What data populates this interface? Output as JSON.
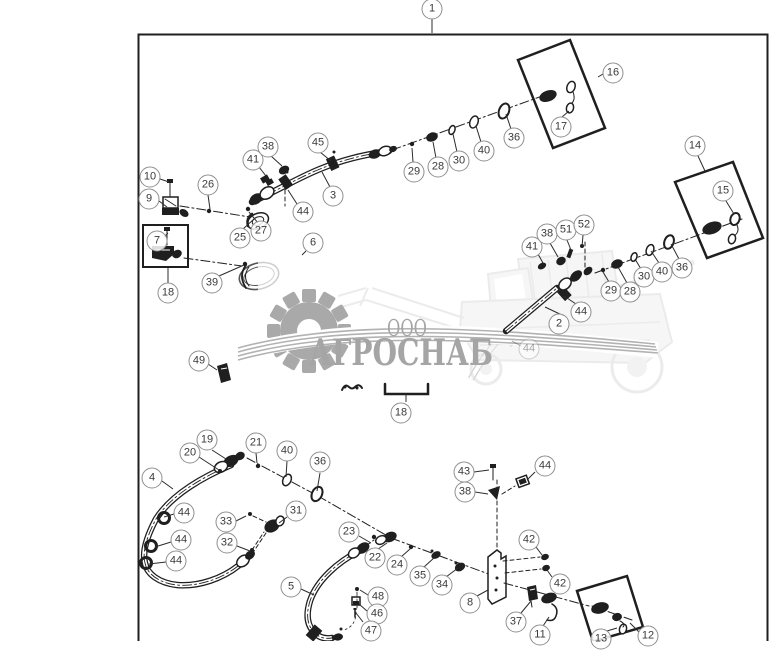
{
  "watermark": {
    "prefix": "ООО",
    "name": "АГРОСНАБ"
  },
  "colors": {
    "line": "#1f1f1f",
    "leader": "#2c2c2c",
    "callout-border": "#8f8f8f",
    "callout-text": "#3a3a3a",
    "wm-text": "#a5a5a5",
    "wm-art": "#dcdcdc",
    "wm-art2": "#f0f0f0",
    "gear": "#a9a9a9"
  },
  "callouts": [
    {
      "id": "1",
      "x": 432,
      "y": 9
    },
    {
      "id": "10",
      "x": 150,
      "y": 177
    },
    {
      "id": "9",
      "x": 149,
      "y": 199
    },
    {
      "id": "26",
      "x": 208,
      "y": 185
    },
    {
      "id": "7",
      "x": 157,
      "y": 241
    },
    {
      "id": "18",
      "x": 168,
      "y": 293
    },
    {
      "id": "25",
      "x": 240,
      "y": 238
    },
    {
      "id": "27",
      "x": 261,
      "y": 231
    },
    {
      "id": "39",
      "x": 212,
      "y": 283
    },
    {
      "id": "6",
      "x": 313,
      "y": 243
    },
    {
      "id": "49",
      "x": 199,
      "y": 361
    },
    {
      "id": "41",
      "x": 253,
      "y": 160
    },
    {
      "id": "38",
      "x": 268,
      "y": 147
    },
    {
      "id": "45",
      "x": 318,
      "y": 143
    },
    {
      "id": "3",
      "x": 333,
      "y": 196
    },
    {
      "id": "44",
      "x": 303,
      "y": 212
    },
    {
      "id": "29",
      "x": 414,
      "y": 172
    },
    {
      "id": "28",
      "x": 438,
      "y": 167
    },
    {
      "id": "30",
      "x": 459,
      "y": 161
    },
    {
      "id": "40",
      "x": 484,
      "y": 151
    },
    {
      "id": "36",
      "x": 514,
      "y": 138
    },
    {
      "id": "16",
      "x": 613,
      "y": 73
    },
    {
      "id": "17",
      "x": 561,
      "y": 127
    },
    {
      "id": "41",
      "x": 532,
      "y": 247
    },
    {
      "id": "38",
      "x": 547,
      "y": 234
    },
    {
      "id": "51",
      "x": 566,
      "y": 230
    },
    {
      "id": "52",
      "x": 584,
      "y": 225
    },
    {
      "id": "29",
      "x": 611,
      "y": 291
    },
    {
      "id": "28",
      "x": 630,
      "y": 292
    },
    {
      "id": "30",
      "x": 644,
      "y": 277
    },
    {
      "id": "40",
      "x": 662,
      "y": 272
    },
    {
      "id": "36",
      "x": 682,
      "y": 268
    },
    {
      "id": "2",
      "x": 559,
      "y": 324
    },
    {
      "id": "44",
      "x": 581,
      "y": 312
    },
    {
      "id": "44",
      "x": 529,
      "y": 349,
      "faded": true
    },
    {
      "id": "14",
      "x": 695,
      "y": 146
    },
    {
      "id": "15",
      "x": 723,
      "y": 191
    },
    {
      "id": "18",
      "x": 401,
      "y": 413
    },
    {
      "id": "4",
      "x": 152,
      "y": 478
    },
    {
      "id": "20",
      "x": 190,
      "y": 453
    },
    {
      "id": "19",
      "x": 207,
      "y": 440
    },
    {
      "id": "21",
      "x": 256,
      "y": 443
    },
    {
      "id": "40",
      "x": 287,
      "y": 451
    },
    {
      "id": "36",
      "x": 320,
      "y": 462
    },
    {
      "id": "44",
      "x": 184,
      "y": 513
    },
    {
      "id": "44",
      "x": 181,
      "y": 540
    },
    {
      "id": "44",
      "x": 176,
      "y": 561
    },
    {
      "id": "33",
      "x": 226,
      "y": 522
    },
    {
      "id": "31",
      "x": 296,
      "y": 511
    },
    {
      "id": "32",
      "x": 227,
      "y": 543
    },
    {
      "id": "23",
      "x": 349,
      "y": 532
    },
    {
      "id": "22",
      "x": 375,
      "y": 558
    },
    {
      "id": "24",
      "x": 397,
      "y": 565
    },
    {
      "id": "35",
      "x": 420,
      "y": 576
    },
    {
      "id": "34",
      "x": 442,
      "y": 585
    },
    {
      "id": "5",
      "x": 291,
      "y": 587
    },
    {
      "id": "48",
      "x": 378,
      "y": 597
    },
    {
      "id": "46",
      "x": 377,
      "y": 614
    },
    {
      "id": "47",
      "x": 371,
      "y": 631
    },
    {
      "id": "43",
      "x": 464,
      "y": 472
    },
    {
      "id": "38",
      "x": 465,
      "y": 492
    },
    {
      "id": "44",
      "x": 545,
      "y": 466
    },
    {
      "id": "42",
      "x": 529,
      "y": 540
    },
    {
      "id": "42",
      "x": 560,
      "y": 584
    },
    {
      "id": "8",
      "x": 470,
      "y": 603
    },
    {
      "id": "37",
      "x": 516,
      "y": 622
    },
    {
      "id": "11",
      "x": 540,
      "y": 635
    },
    {
      "id": "13",
      "x": 601,
      "y": 639
    },
    {
      "id": "12",
      "x": 648,
      "y": 636
    }
  ]
}
